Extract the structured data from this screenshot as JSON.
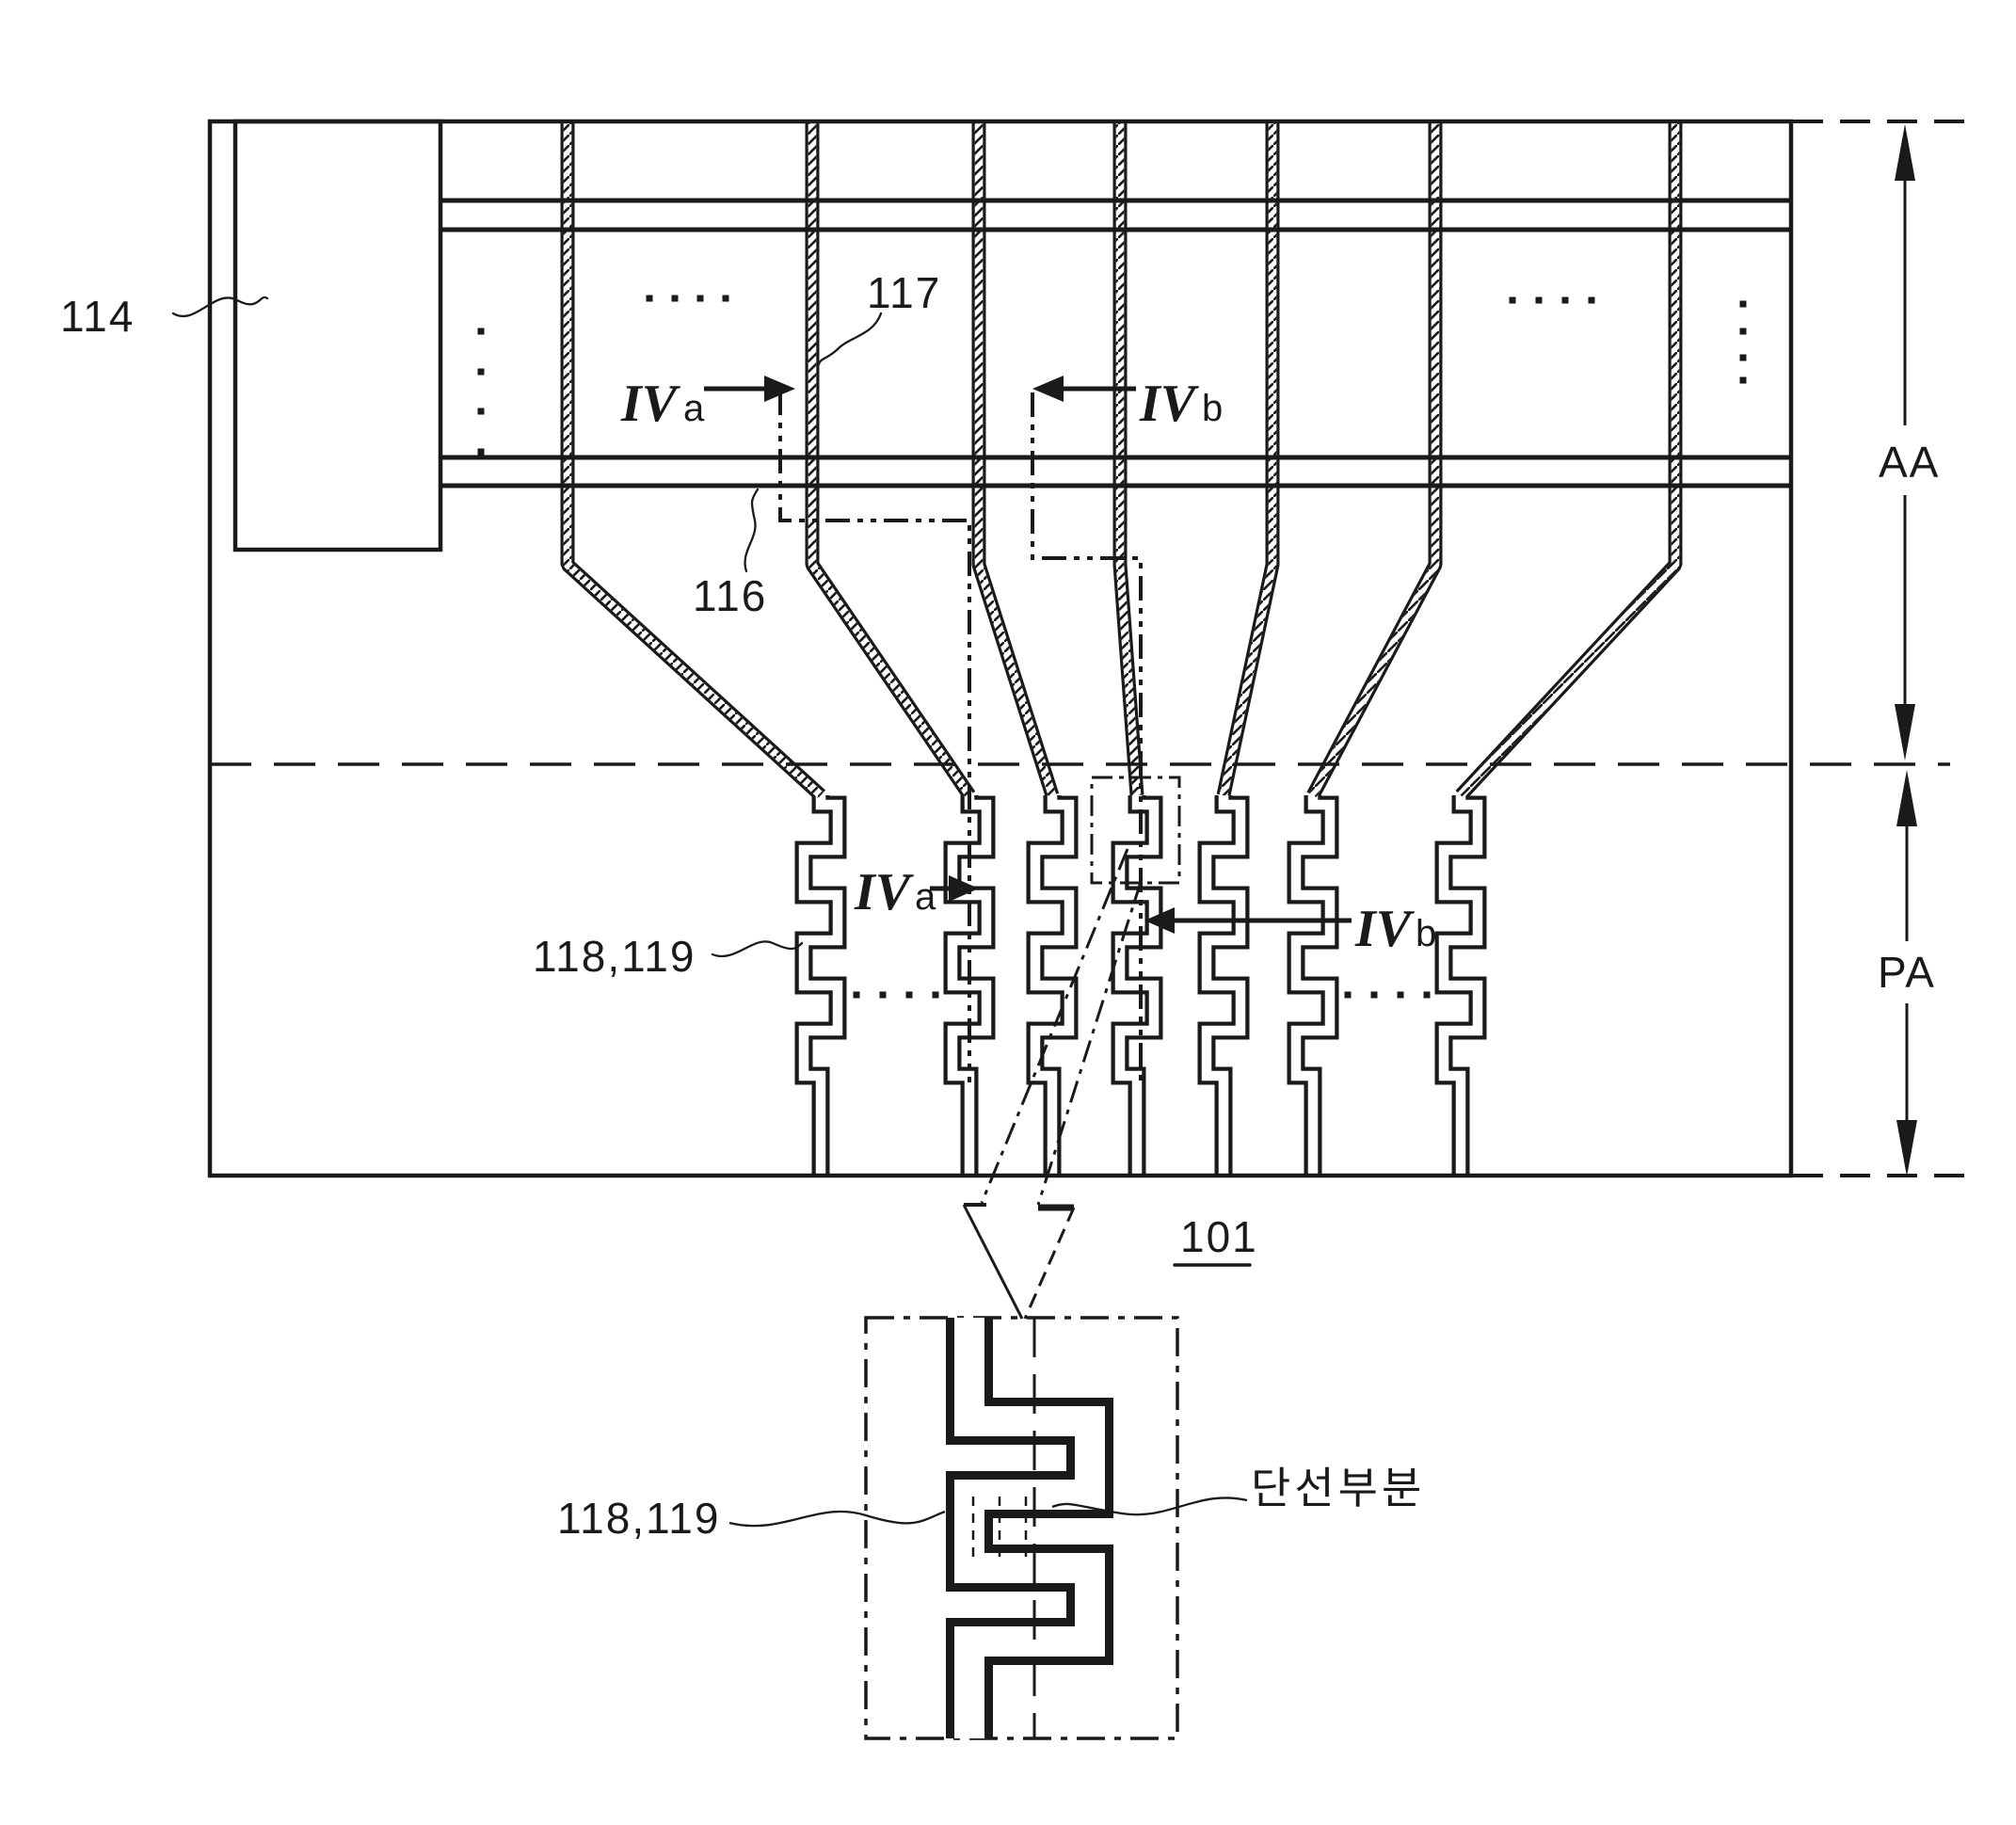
{
  "diagram": {
    "title_hidden": "",
    "ref_gate_driver": "114",
    "ref_gate_line": "116",
    "ref_data_line": "117",
    "ref_pads": "118,119",
    "ref_substrate": "101",
    "ref_inset_pads": "118,119",
    "disconnection_label": "단선부분",
    "area_active": "AA",
    "area_pad": "PA",
    "section_a_prefix": "IV",
    "section_a_suffix": "a",
    "section_b_prefix": "IV",
    "section_b_suffix": "b",
    "colors": {
      "ink": "#1a1a1a",
      "background": "#ffffff"
    }
  }
}
